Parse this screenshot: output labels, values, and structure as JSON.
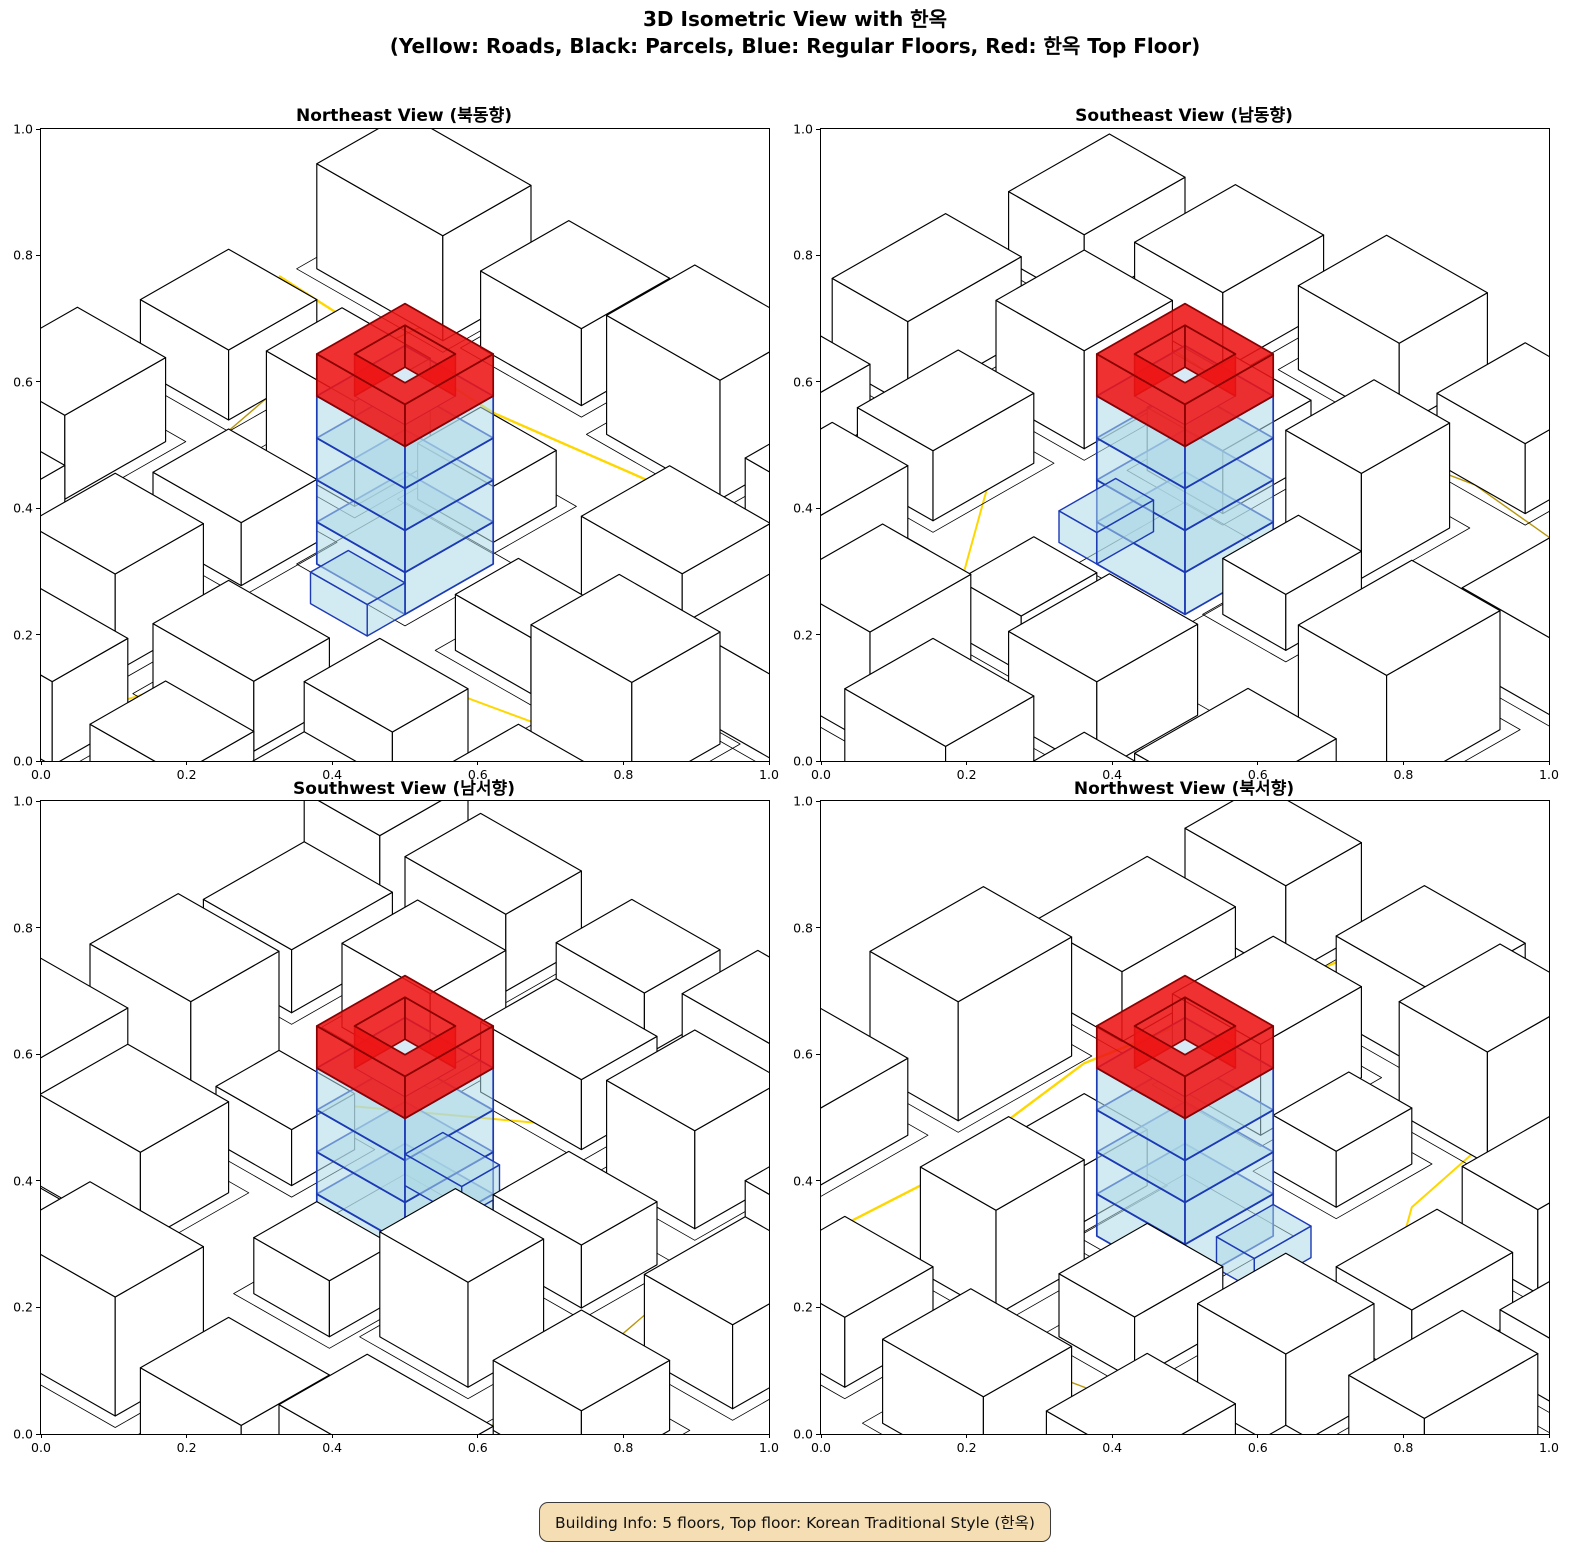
{
  "figure": {
    "suptitle_line1": "3D Isometric View with 한옥",
    "suptitle_line2": "(Yellow: Roads, Black: Parcels, Blue: Regular Floors, Red: 한옥 Top Floor)"
  },
  "subplots": [
    {
      "view_id": "northeast",
      "title": "Northeast View (북동향)",
      "rotation": 0
    },
    {
      "view_id": "southeast",
      "title": "Southeast View (남동향)",
      "rotation": 1
    },
    {
      "view_id": "southwest",
      "title": "Southwest View (남서향)",
      "rotation": 2
    },
    {
      "view_id": "northwest",
      "title": "Northwest View (북서향)",
      "rotation": 3
    }
  ],
  "axes": {
    "xticks": [
      "0.0",
      "0.2",
      "0.4",
      "0.6",
      "0.8",
      "1.0"
    ],
    "yticks": [
      "0.0",
      "0.2",
      "0.4",
      "0.6",
      "0.8",
      "1.0"
    ],
    "xlim": [
      0.0,
      1.0
    ],
    "ylim": [
      0.0,
      1.0
    ]
  },
  "legend_meaning": {
    "yellow": "Roads",
    "black": "Parcels",
    "blue": "Regular Floors",
    "red": "한옥 Top Floor"
  },
  "building": {
    "floors": 5,
    "regular_floors": 4,
    "top_floor_style": "Korean Traditional Style (한옥)"
  },
  "info_box": {
    "text": "Building Info: 5 floors, Top floor: Korean Traditional Style (한옥)",
    "bg": "#F5DEB3",
    "border": "#3a3a3a"
  },
  "scene": {
    "proj": {
      "a": 6.3,
      "b": 3.6,
      "c": 7,
      "cx": 364,
      "cy": 435
    },
    "colors": {
      "building_fill": "#ffffff",
      "building_edge": "#000000",
      "parcel_edge": "#000000",
      "road_bright": "#FFD700",
      "road_dark": "#B8960B",
      "floor_fill": "rgba(173,216,230,0.55)",
      "floor_edge": "#1d3ab5",
      "court_fill": "#d8eaf6",
      "hanok_fill": "rgba(238,20,20,0.88)",
      "hanok_edge": "#8b0000"
    },
    "roads": [
      {
        "pts": [
          [
            -50,
            -30
          ],
          [
            -14,
            -28
          ],
          [
            16,
            -32
          ],
          [
            50,
            -26
          ]
        ],
        "color": "#FFD700",
        "w": 2.4
      },
      {
        "pts": [
          [
            -30,
            50
          ],
          [
            -28,
            18
          ],
          [
            -34,
            -12
          ],
          [
            -30,
            -50
          ]
        ],
        "color": "#B8960B",
        "w": 1.4
      },
      {
        "pts": [
          [
            50,
            8
          ],
          [
            22,
            14
          ],
          [
            0,
            30
          ],
          [
            -6,
            50
          ]
        ],
        "color": "#FFD700",
        "w": 2.0
      },
      {
        "pts": [
          [
            -50,
            38
          ],
          [
            -36,
            34
          ],
          [
            -24,
            40
          ],
          [
            -20,
            50
          ]
        ],
        "color": "#B8960B",
        "w": 1.2
      }
    ],
    "buildings": [
      [
        -48,
        -48,
        20,
        14,
        15
      ],
      [
        -24,
        -50,
        16,
        14,
        11
      ],
      [
        -2,
        -48,
        18,
        14,
        17
      ],
      [
        22,
        -46,
        18,
        14,
        10
      ],
      [
        44,
        -44,
        12,
        16,
        13
      ],
      [
        -48,
        -20,
        14,
        14,
        10
      ],
      [
        -26,
        -16,
        14,
        12,
        15
      ],
      [
        -8,
        -20,
        12,
        10,
        8
      ],
      [
        20,
        -22,
        16,
        14,
        13
      ],
      [
        42,
        -18,
        14,
        16,
        12
      ],
      [
        -50,
        2,
        14,
        16,
        12
      ],
      [
        -24,
        4,
        14,
        12,
        9
      ],
      [
        16,
        -2,
        12,
        10,
        8
      ],
      [
        34,
        0,
        16,
        14,
        16
      ],
      [
        -46,
        24,
        16,
        14,
        11
      ],
      [
        -22,
        24,
        14,
        14,
        14
      ],
      [
        -2,
        26,
        16,
        12,
        10
      ],
      [
        20,
        24,
        14,
        12,
        12
      ],
      [
        40,
        22,
        14,
        16,
        9
      ],
      [
        -44,
        44,
        16,
        12,
        10
      ],
      [
        -18,
        44,
        18,
        12,
        12
      ],
      [
        6,
        44,
        14,
        12,
        9
      ],
      [
        26,
        42,
        16,
        12,
        11
      ],
      [
        44,
        40,
        12,
        14,
        14
      ]
    ],
    "tower": {
      "rect": [
        -7,
        -7,
        14,
        14
      ],
      "floor_h": 6,
      "regular_floors": 4,
      "hole": [
        -4,
        -4,
        8,
        8
      ],
      "annex": [
        -2,
        7,
        9,
        6,
        4.5
      ]
    }
  }
}
